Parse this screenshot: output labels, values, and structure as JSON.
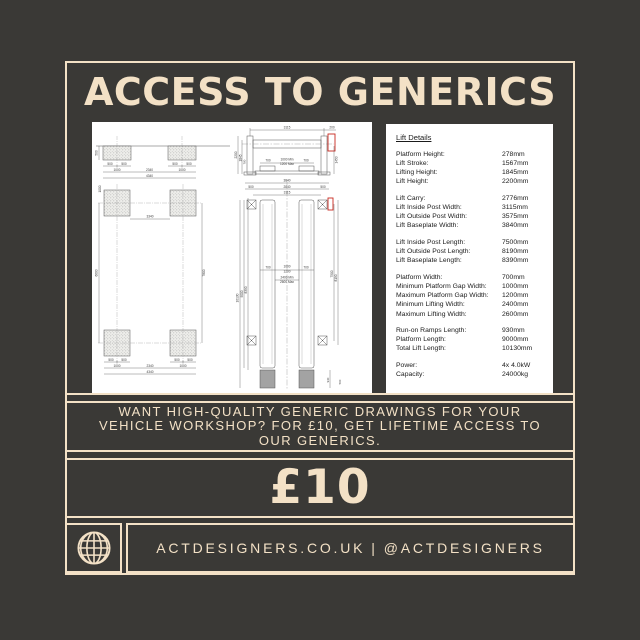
{
  "theme": {
    "bg": "#3a3936",
    "cream": "#f3e1c6",
    "paper": "#ffffff",
    "ink": "#1b1b1b",
    "red": "#c8281e"
  },
  "header": {
    "title": "ACCESS TO GENERICS"
  },
  "promo": {
    "lines": [
      "WANT HIGH-QUALITY GENERIC DRAWINGS FOR YOUR",
      "VEHICLE WORKSHOP? FOR £10, GET LIFETIME ACCESS TO",
      "OUR GENERICS."
    ]
  },
  "price": {
    "amount": "£10"
  },
  "footer": {
    "website": "ACTDESIGNERS.CO.UK",
    "separator": "|",
    "handle": "@ACTDESIGNERS"
  },
  "lift_details": {
    "heading": "Lift Details",
    "rows": [
      {
        "l": "Platform Height:",
        "v": "278mm"
      },
      {
        "l": "Lift Stroke:",
        "v": "1567mm"
      },
      {
        "l": "Lifting Height:",
        "v": "1845mm"
      },
      {
        "l": "Lift Height:",
        "v": "2200mm"
      },
      {
        "l": "",
        "v": ""
      },
      {
        "l": "Lift Carry:",
        "v": "2776mm"
      },
      {
        "l": "Lift Inside Post Width:",
        "v": "3115mm"
      },
      {
        "l": "Lift Outside Post Width:",
        "v": "3575mm"
      },
      {
        "l": "Lift Baseplate Width:",
        "v": "3840mm"
      },
      {
        "l": "",
        "v": ""
      },
      {
        "l": "Lift Inside Post Length:",
        "v": "7500mm"
      },
      {
        "l": "Lift Outside Post Length:",
        "v": "8190mm"
      },
      {
        "l": "Lift Baseplate Length:",
        "v": "8390mm"
      },
      {
        "l": "",
        "v": ""
      },
      {
        "l": "Platform Width:",
        "v": "700mm"
      },
      {
        "l": "Minimum Platform Gap Width:",
        "v": "1000mm"
      },
      {
        "l": "Maximum Platform Gap Width:",
        "v": "1200mm"
      },
      {
        "l": "Minimum Lifting Width:",
        "v": "2400mm"
      },
      {
        "l": "Maximum Lifting Width:",
        "v": "2600mm"
      },
      {
        "l": "",
        "v": ""
      },
      {
        "l": "Run-on Ramps Length:",
        "v": "930mm"
      },
      {
        "l": "Platform Length:",
        "v": "9000mm"
      },
      {
        "l": "Total Lift Length:",
        "v": "10130mm"
      },
      {
        "l": "",
        "v": ""
      },
      {
        "l": "Power:",
        "v": "4x 4.0kW"
      },
      {
        "l": "Capacity:",
        "v": "24000kg"
      }
    ]
  },
  "drawings": {
    "foundation_section": {
      "depth": "500",
      "pad_half_a": "500",
      "pad_half_b": "500",
      "pad": "1000",
      "between": "2340",
      "overall": "4340"
    },
    "foundation_plan": {
      "inner": "3340",
      "pad_half_a": "500",
      "pad_half_b": "500",
      "pad": "1000",
      "between": "2340",
      "overall": "4340",
      "left_len": "6600",
      "right_len": "7800"
    },
    "elevation": {
      "span": "3115",
      "offset": "200",
      "lift_height": "2200",
      "lifting_height": "1845",
      "beam": "780",
      "platform_a": "700",
      "gap_min": "1000 Min",
      "gap_max": "1200 Max",
      "platform_b": "700",
      "right_h": "1450"
    },
    "plan": {
      "baseplate_w": "3840",
      "outer": "2840",
      "edge_a": "500",
      "edge_b": "500",
      "span": "3115",
      "platform_a": "700",
      "platform_b": "700",
      "gap_min": "1000",
      "gap_max": "1200",
      "lift_min": "2400 Min",
      "lift_max": "2600 Max",
      "total": "10130",
      "platform_len": "9000",
      "baseplate_len": "8390",
      "inside_post": "7500",
      "outside_post": "8190",
      "ramp": "930",
      "ramp_edge": "500"
    }
  }
}
